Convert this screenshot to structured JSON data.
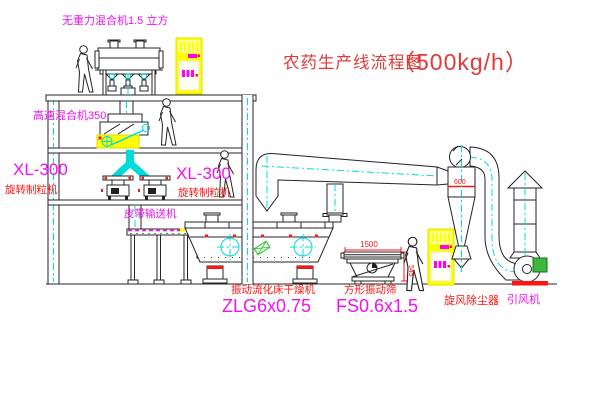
{
  "title": {
    "cn": "农药生产线流程图",
    "capacity": "（500kg/h）"
  },
  "labels": {
    "gravity_mixer": "无重力混合机1.5 立方",
    "high_speed_mixer": "高速混合机350",
    "granulator_left_model": "XL-300",
    "granulator_left_name": "旋转制粒机",
    "granulator_mid_model": "XL-300",
    "granulator_mid_name": "旋转制粒机",
    "belt_conveyor": "皮带输送机",
    "dryer_name": "振动流化床干燥机",
    "dryer_model": "ZLG6x0.75",
    "screen_name": "方形振动筛",
    "screen_model": "FS0.6x1.5",
    "cyclone_name": "旋风除尘器",
    "fan_name": "引风机"
  },
  "dimensions": {
    "screen_length": "1500",
    "screen_height": "545",
    "cyclone_diameter": "600"
  },
  "colors": {
    "drawing_line": "#242424",
    "centerline_cyan": "#00dcdc",
    "label_magenta": "#f012f0",
    "label_red": "#ff1414",
    "title_red": "#e03a3a",
    "cabinet_yellow": "#ffff00",
    "motor_green": "#2eb82e",
    "background": "#ffffff"
  }
}
